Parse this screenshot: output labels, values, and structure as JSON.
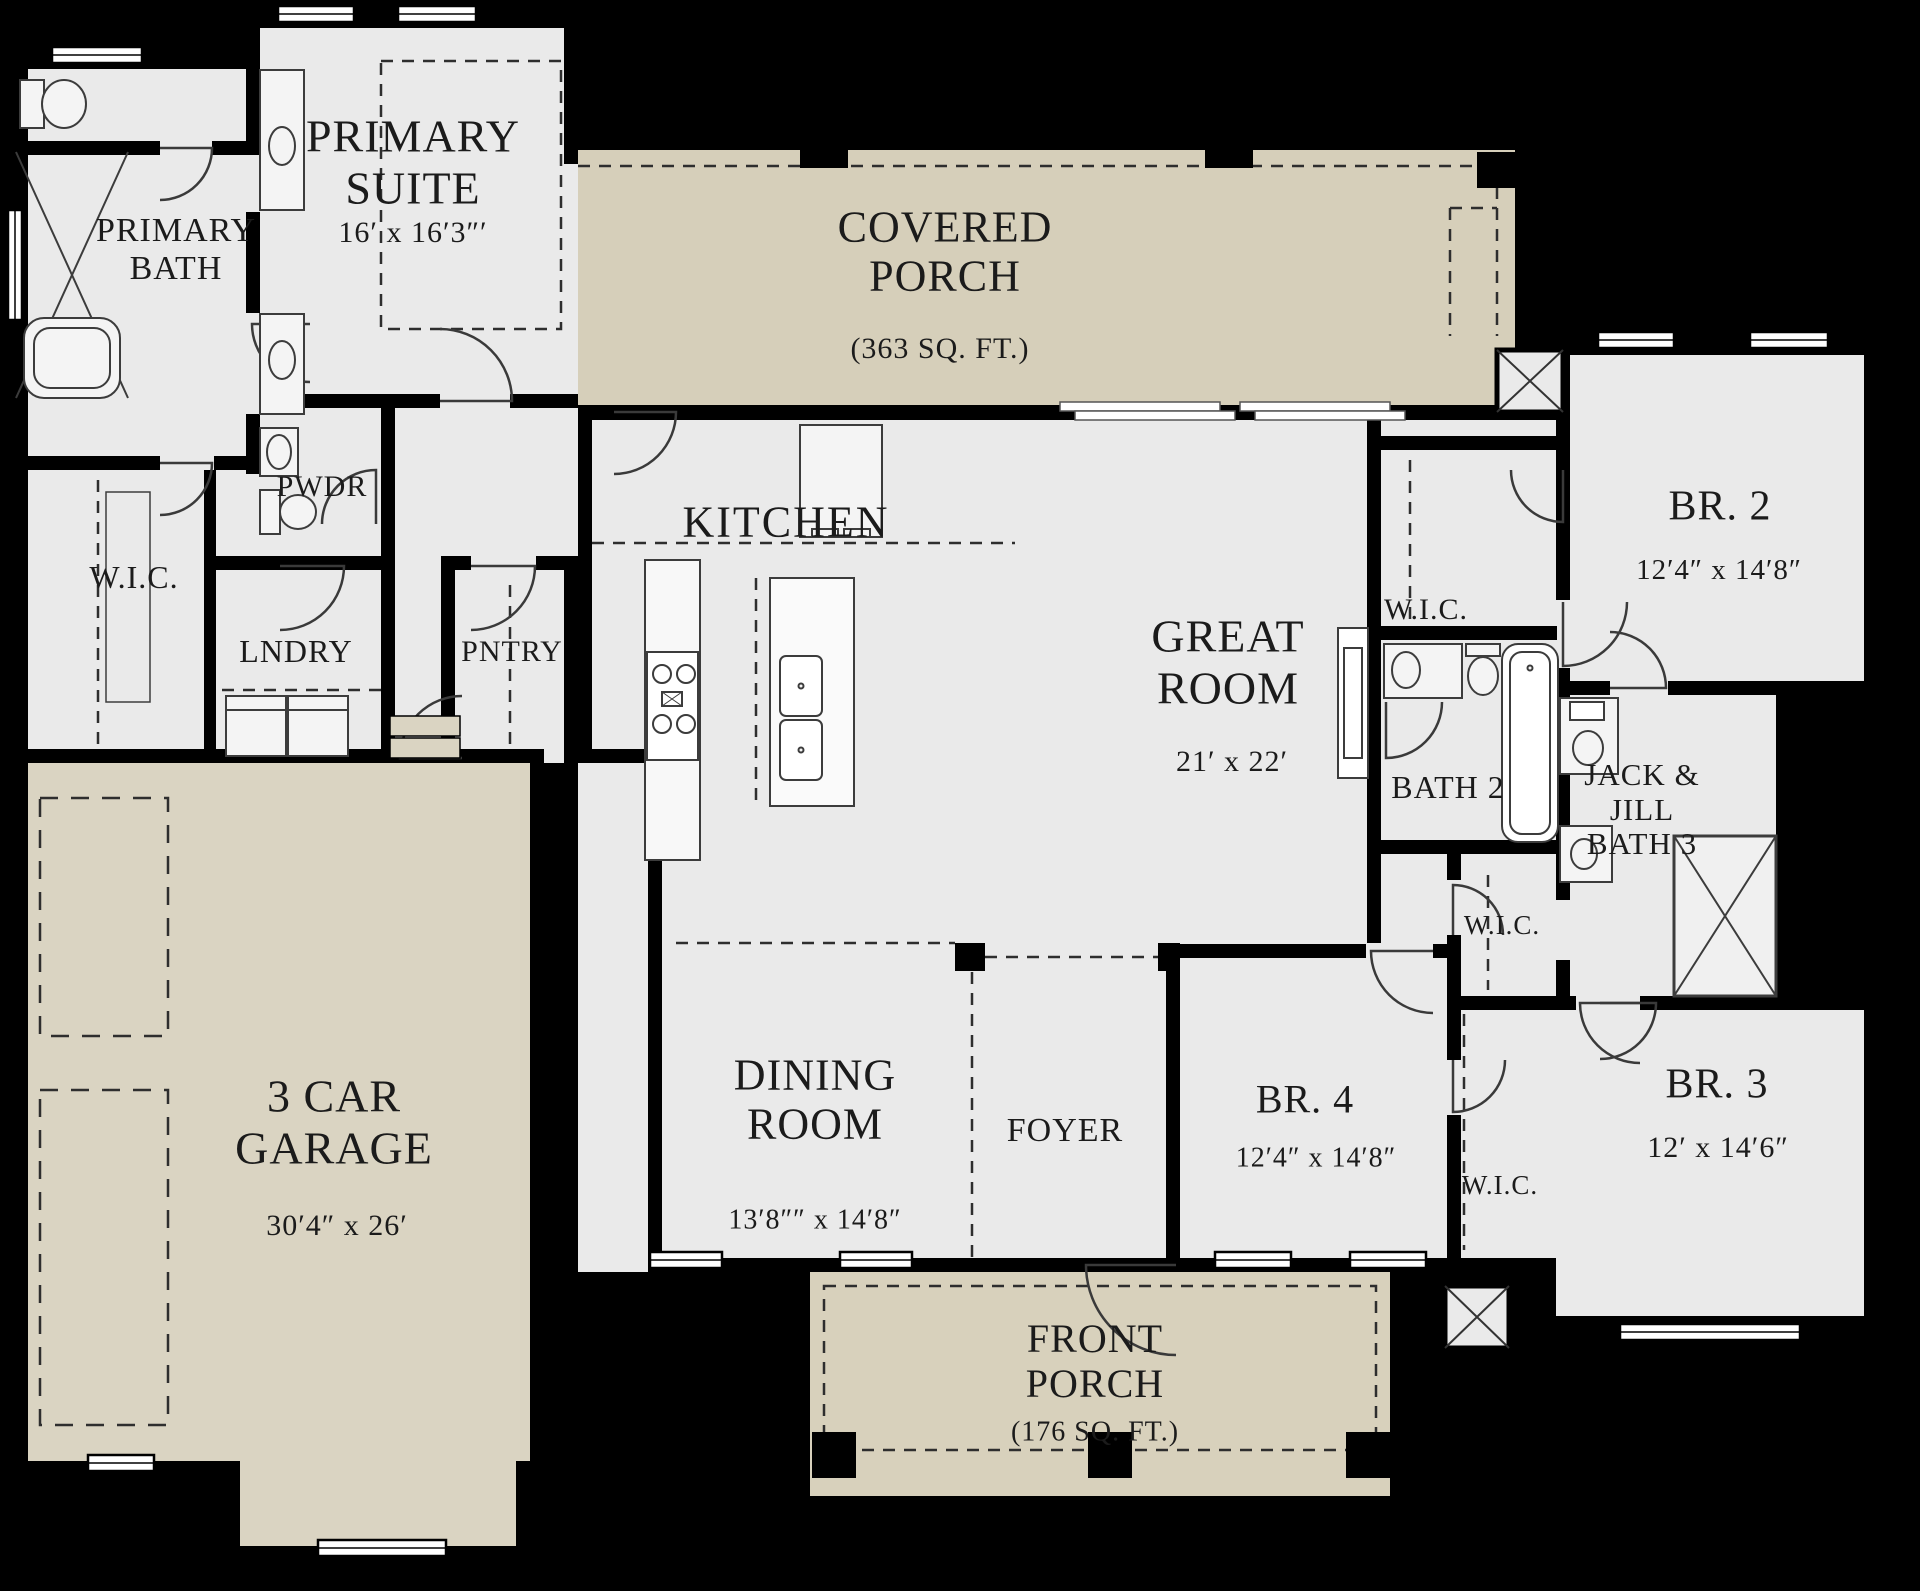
{
  "palette": {
    "background": "#000000",
    "floor": "#eaeaea",
    "covered_porch": "#d6cfba",
    "front_porch": "#d8d1bc",
    "garage": "#dad4c2",
    "wall": "#000000",
    "fixture_line": "#3c3c3c",
    "text": "#1b1b1b"
  },
  "rooms": {
    "primary_bath": {
      "name": "PRIMARY\nBATH"
    },
    "primary_suite": {
      "name": "PRIMARY\nSUITE",
      "dims": "16′ x 16′3″′"
    },
    "covered_porch": {
      "name": "COVERED\nPORCH",
      "area": "(363 SQ. FT.)"
    },
    "pwdr": {
      "name": "PWDR"
    },
    "wic_primary": {
      "name": "W.I.C."
    },
    "lndry": {
      "name": "LNDRY"
    },
    "pntry": {
      "name": "PNTRY"
    },
    "kitchen": {
      "name": "KITCHEN"
    },
    "great_room": {
      "name": "GREAT\nROOM",
      "dims": "21′ x 22′"
    },
    "br2": {
      "name": "BR. 2",
      "dims": "12′4″ x 14′8″"
    },
    "wic_br2": {
      "name": "W.I.C."
    },
    "bath2": {
      "name": "BATH 2"
    },
    "jack_jill_bath3": {
      "name": "JACK &\nJILL\nBATH 3"
    },
    "wic_mid": {
      "name": "W.I.C."
    },
    "garage": {
      "name": "3 CAR\nGARAGE",
      "dims": "30′4″ x 26′"
    },
    "dining": {
      "name": "DINING\nROOM",
      "dims": "13′8″″ x 14′8″"
    },
    "foyer": {
      "name": "FOYER"
    },
    "br4": {
      "name": "BR. 4",
      "dims": "12′4″ x 14′8″"
    },
    "wic_br4": {
      "name": "W.I.C."
    },
    "br3": {
      "name": "BR. 3",
      "dims": "12′ x 14′6″"
    },
    "front_porch": {
      "name": "FRONT\nPORCH",
      "area": "(176 SQ. FT.)"
    }
  }
}
